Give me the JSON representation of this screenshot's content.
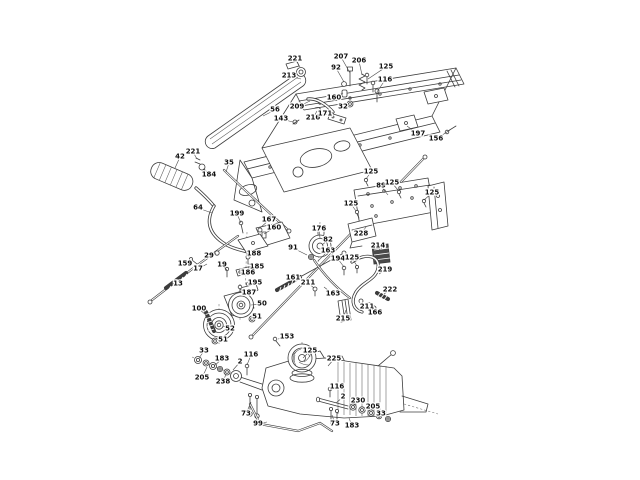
{
  "document": {
    "background": "#ffffff",
    "line_color": "#3c3c3c",
    "label_color": "#101010",
    "pad_fill": "#4a4a4a"
  },
  "diagram": {
    "type": "exploded-parts-diagram",
    "callouts": [
      {
        "n": "221",
        "x": 295,
        "y": 58,
        "tx": 300,
        "ty": 67
      },
      {
        "n": "213",
        "x": 289,
        "y": 75,
        "tx": 301,
        "ty": 79
      },
      {
        "n": "207",
        "x": 341,
        "y": 56,
        "tx": 350,
        "ty": 73
      },
      {
        "n": "92",
        "x": 336,
        "y": 67,
        "tx": 344,
        "ty": 82
      },
      {
        "n": "206",
        "x": 359,
        "y": 60,
        "tx": 362,
        "ty": 75
      },
      {
        "n": "125",
        "x": 386,
        "y": 66,
        "tx": 368,
        "ty": 79
      },
      {
        "n": "116",
        "x": 385,
        "y": 79,
        "tx": 377,
        "ty": 92
      },
      {
        "n": "160",
        "x": 334,
        "y": 97,
        "tx": 343,
        "ty": 93
      },
      {
        "n": "32",
        "x": 343,
        "y": 106,
        "tx": 349,
        "ty": 103
      },
      {
        "n": "209",
        "x": 297,
        "y": 106,
        "tx": 310,
        "ty": 101
      },
      {
        "n": "56",
        "x": 275,
        "y": 109,
        "tx": 263,
        "ty": 116
      },
      {
        "n": "143",
        "x": 281,
        "y": 118,
        "tx": 293,
        "ty": 122
      },
      {
        "n": "216",
        "x": 313,
        "y": 117,
        "tx": 317,
        "ty": 111
      },
      {
        "n": "171",
        "x": 325,
        "y": 113,
        "tx": 333,
        "ty": 116
      },
      {
        "n": "197",
        "x": 418,
        "y": 133,
        "tx": 407,
        "ty": 126
      },
      {
        "n": "156",
        "x": 436,
        "y": 138,
        "tx": 450,
        "ty": 130
      },
      {
        "n": "42",
        "x": 180,
        "y": 156,
        "tx": 175,
        "ty": 168
      },
      {
        "n": "221",
        "x": 193,
        "y": 151,
        "tx": 197,
        "ty": 159
      },
      {
        "n": "184",
        "x": 209,
        "y": 174,
        "tx": 203,
        "ty": 169
      },
      {
        "n": "35",
        "x": 229,
        "y": 162,
        "tx": 226,
        "ty": 172
      },
      {
        "n": "64",
        "x": 198,
        "y": 207,
        "tx": 212,
        "ty": 213
      },
      {
        "n": "199",
        "x": 237,
        "y": 213,
        "tx": 241,
        "ty": 223
      },
      {
        "n": "167",
        "x": 269,
        "y": 219,
        "tx": 260,
        "ty": 228
      },
      {
        "n": "160",
        "x": 274,
        "y": 227,
        "tx": 264,
        "ty": 234
      },
      {
        "n": "159",
        "x": 185,
        "y": 263,
        "tx": 192,
        "ty": 260
      },
      {
        "n": "17",
        "x": 198,
        "y": 268,
        "tx": 207,
        "ty": 264
      },
      {
        "n": "13",
        "x": 178,
        "y": 283,
        "tx": 176,
        "ty": 280
      },
      {
        "n": "29",
        "x": 209,
        "y": 255,
        "tx": 216,
        "ty": 253
      },
      {
        "n": "19",
        "x": 222,
        "y": 264,
        "tx": 227,
        "ty": 270
      },
      {
        "n": "188",
        "x": 254,
        "y": 253,
        "tx": 248,
        "ty": 257
      },
      {
        "n": "185",
        "x": 257,
        "y": 266,
        "tx": 250,
        "ty": 267
      },
      {
        "n": "186",
        "x": 248,
        "y": 272,
        "tx": 242,
        "ty": 273
      },
      {
        "n": "195",
        "x": 255,
        "y": 282,
        "tx": 249,
        "ty": 284
      },
      {
        "n": "187",
        "x": 249,
        "y": 292,
        "tx": 243,
        "ty": 291
      },
      {
        "n": "100",
        "x": 199,
        "y": 308,
        "tx": 206,
        "ty": 315
      },
      {
        "n": "50",
        "x": 262,
        "y": 303,
        "tx": 251,
        "ty": 305
      },
      {
        "n": "51",
        "x": 257,
        "y": 316,
        "tx": 251,
        "ty": 318
      },
      {
        "n": "52",
        "x": 230,
        "y": 328,
        "tx": 223,
        "ty": 326
      },
      {
        "n": "51",
        "x": 223,
        "y": 339,
        "tx": 216,
        "ty": 339
      },
      {
        "n": "176",
        "x": 319,
        "y": 228,
        "tx": 320,
        "ty": 238
      },
      {
        "n": "82",
        "x": 328,
        "y": 239,
        "tx": 322,
        "ty": 245
      },
      {
        "n": "91",
        "x": 293,
        "y": 247,
        "tx": 307,
        "ty": 255
      },
      {
        "n": "161",
        "x": 293,
        "y": 277,
        "tx": 287,
        "ty": 283
      },
      {
        "n": "211",
        "x": 308,
        "y": 282,
        "tx": 314,
        "ty": 288
      },
      {
        "n": "153",
        "x": 287,
        "y": 336,
        "tx": 278,
        "ty": 339
      },
      {
        "n": "33",
        "x": 204,
        "y": 350,
        "tx": 199,
        "ty": 358
      },
      {
        "n": "183",
        "x": 222,
        "y": 358,
        "tx": 214,
        "ty": 366
      },
      {
        "n": "116",
        "x": 251,
        "y": 354,
        "tx": 247,
        "ty": 365
      },
      {
        "n": "2",
        "x": 240,
        "y": 361,
        "tx": 233,
        "ty": 370
      },
      {
        "n": "205",
        "x": 202,
        "y": 377,
        "tx": 207,
        "ty": 367
      },
      {
        "n": "238",
        "x": 223,
        "y": 381,
        "tx": 226,
        "ty": 374
      },
      {
        "n": "73",
        "x": 246,
        "y": 413,
        "tx": 251,
        "ty": 402
      },
      {
        "n": "99",
        "x": 258,
        "y": 423,
        "tx": 267,
        "ty": 422
      },
      {
        "n": "125",
        "x": 310,
        "y": 350,
        "tx": 303,
        "ty": 358
      },
      {
        "n": "225",
        "x": 334,
        "y": 358,
        "tx": 328,
        "ty": 366
      },
      {
        "n": "116",
        "x": 337,
        "y": 386,
        "tx": 330,
        "ty": 390
      },
      {
        "n": "2",
        "x": 343,
        "y": 396,
        "tx": 336,
        "ty": 403
      },
      {
        "n": "230",
        "x": 358,
        "y": 400,
        "tx": 353,
        "ty": 406
      },
      {
        "n": "205",
        "x": 373,
        "y": 406,
        "tx": 369,
        "ty": 411
      },
      {
        "n": "33",
        "x": 381,
        "y": 413,
        "tx": 378,
        "ty": 416
      },
      {
        "n": "73",
        "x": 335,
        "y": 423,
        "tx": 332,
        "ty": 415
      },
      {
        "n": "183",
        "x": 352,
        "y": 425,
        "tx": 349,
        "ty": 418
      },
      {
        "n": "125",
        "x": 371,
        "y": 171,
        "tx": 366,
        "ty": 179
      },
      {
        "n": "89",
        "x": 381,
        "y": 185,
        "tx": 388,
        "ty": 195
      },
      {
        "n": "125",
        "x": 392,
        "y": 182,
        "tx": 398,
        "ty": 190
      },
      {
        "n": "125",
        "x": 432,
        "y": 192,
        "tx": 424,
        "ty": 200
      },
      {
        "n": "125",
        "x": 351,
        "y": 203,
        "tx": 356,
        "ty": 211
      },
      {
        "n": "228",
        "x": 361,
        "y": 233,
        "tx": 366,
        "ty": 227
      },
      {
        "n": "214",
        "x": 378,
        "y": 245,
        "tx": 380,
        "ty": 250
      },
      {
        "n": "194",
        "x": 338,
        "y": 258,
        "tx": 344,
        "ty": 267
      },
      {
        "n": "125",
        "x": 352,
        "y": 257,
        "tx": 357,
        "ty": 266
      },
      {
        "n": "163",
        "x": 328,
        "y": 250,
        "tx": 318,
        "ty": 261
      },
      {
        "n": "163",
        "x": 333,
        "y": 293,
        "tx": 324,
        "ty": 287
      },
      {
        "n": "219",
        "x": 385,
        "y": 269,
        "tx": 379,
        "ty": 274
      },
      {
        "n": "222",
        "x": 390,
        "y": 289,
        "tx": 384,
        "ty": 294
      },
      {
        "n": "211",
        "x": 367,
        "y": 306,
        "tx": 362,
        "ty": 302
      },
      {
        "n": "215",
        "x": 343,
        "y": 318,
        "tx": 346,
        "ty": 310
      },
      {
        "n": "166",
        "x": 375,
        "y": 312,
        "tx": 371,
        "ty": 307
      }
    ]
  }
}
